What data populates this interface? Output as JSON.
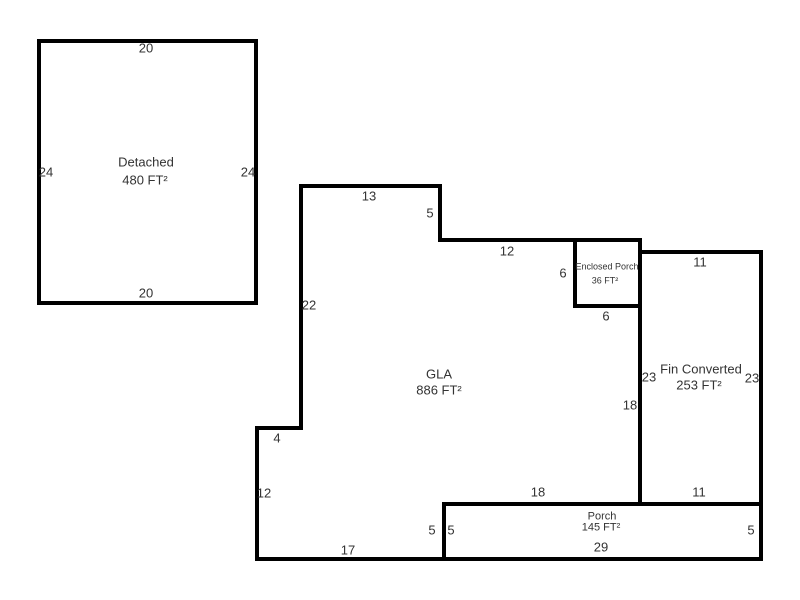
{
  "sketch": {
    "detached": {
      "name": "Detached",
      "area": "480 FT²",
      "dim_top": "20",
      "dim_left": "24",
      "dim_right": "24",
      "dim_bottom": "20"
    },
    "gla": {
      "name": "GLA",
      "area": "886 FT²",
      "dim_top_13": "13",
      "dim_step_5": "5",
      "dim_top_12": "12",
      "dim_left_22": "22",
      "dim_right_18": "18",
      "dim_bottom_18": "18",
      "dim_notch_4": "4",
      "dim_left_12": "12",
      "dim_bottom_17": "17",
      "dim_right_5": "5"
    },
    "enclosed_porch": {
      "name": "Enclosed Porch",
      "area": "36 FT²",
      "dim_left": "6",
      "dim_bottom": "6"
    },
    "fin_converted": {
      "name": "Fin Converted",
      "area": "253 FT²",
      "dim_top": "11",
      "dim_left": "23",
      "dim_right": "23",
      "dim_bottom": "11"
    },
    "porch": {
      "name": "Porch",
      "area": "145 FT²",
      "dim_top": "18",
      "dim_left": "5",
      "dim_right": "5",
      "dim_bottom": "29"
    }
  },
  "colors": {
    "wall": "#000000",
    "text": "#333333",
    "background": "#ffffff"
  }
}
